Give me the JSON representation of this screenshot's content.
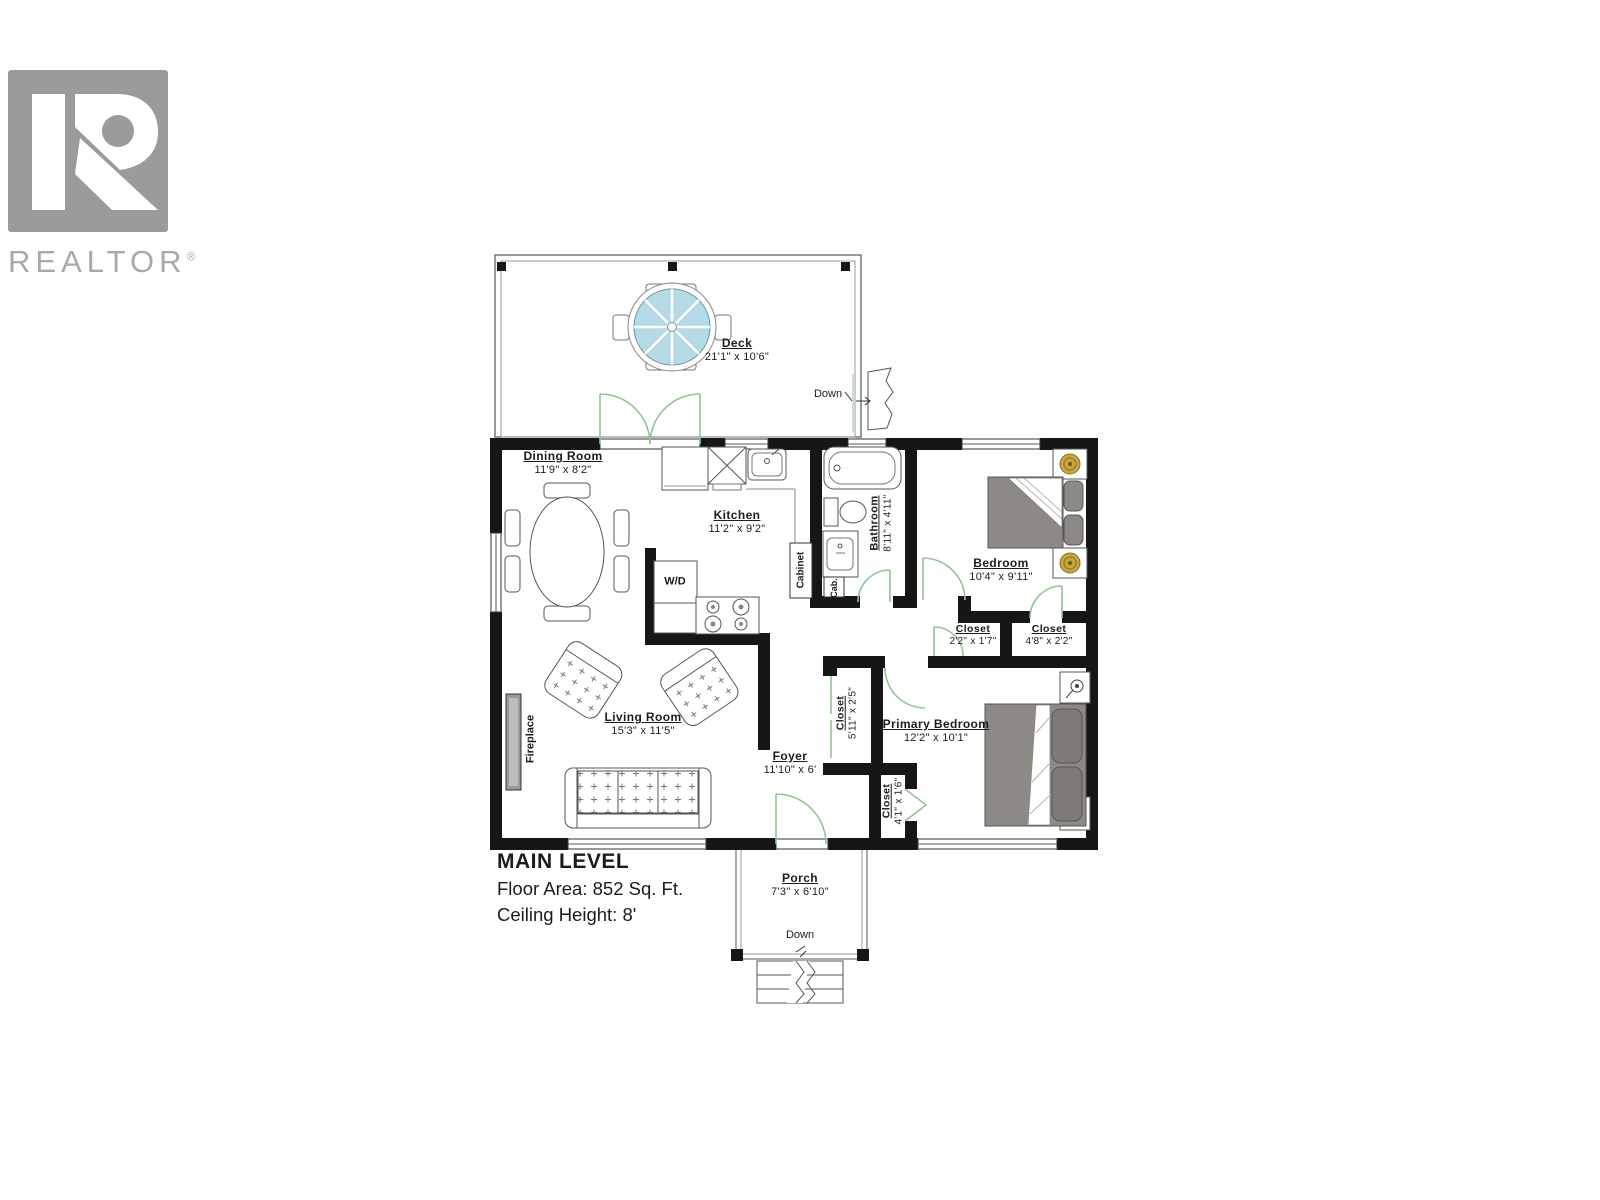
{
  "logo": {
    "brand": "REALTOR",
    "registered": "®"
  },
  "level": {
    "title": "MAIN LEVEL",
    "floor_area": "Floor Area: 852 Sq. Ft.",
    "ceiling": "Ceiling Height: 8'"
  },
  "rooms": {
    "deck": {
      "name": "Deck",
      "dims": "21'1\" x 10'6\""
    },
    "dining": {
      "name": "Dining Room",
      "dims": "11'9\" x 8'2\""
    },
    "kitchen": {
      "name": "Kitchen",
      "dims": "11'2\" x 9'2\""
    },
    "bathroom": {
      "name": "Bathroom",
      "dims": "8'11\" x 4'11\""
    },
    "bedroom": {
      "name": "Bedroom",
      "dims": "10'4\" x 9'11\""
    },
    "closet_hall": {
      "name": "Closet",
      "dims": "2'2\" x 1'7\""
    },
    "closet_bedroom": {
      "name": "Closet",
      "dims": "4'8\" x 2'2\""
    },
    "closet_foyer": {
      "name": "Closet",
      "dims": "5'11\" x 2'5\""
    },
    "closet_primary": {
      "name": "Closet",
      "dims": "4'1\" x 1'6\""
    },
    "primary_bedroom": {
      "name": "Primary Bedroom",
      "dims": "12'2\" x 10'1\""
    },
    "living": {
      "name": "Living Room",
      "dims": "15'3\" x 11'5\""
    },
    "foyer": {
      "name": "Foyer",
      "dims": "11'10\" x 6'"
    },
    "porch": {
      "name": "Porch",
      "dims": "7'3\" x 6'10\""
    }
  },
  "annotations": {
    "wd": "W/D",
    "cabinet": "Cabinet",
    "cab": "Cab.",
    "fireplace": "Fireplace",
    "deck_down": "Down",
    "porch_down": "Down"
  },
  "colors": {
    "walls": "#161616",
    "doors_green": "#93c493",
    "umbrella_blue": "#b5d9e6",
    "furniture_gray": "#8d8a85",
    "lamp_gold": "#c9a53f",
    "logo_gray": "#9b9b9b"
  }
}
